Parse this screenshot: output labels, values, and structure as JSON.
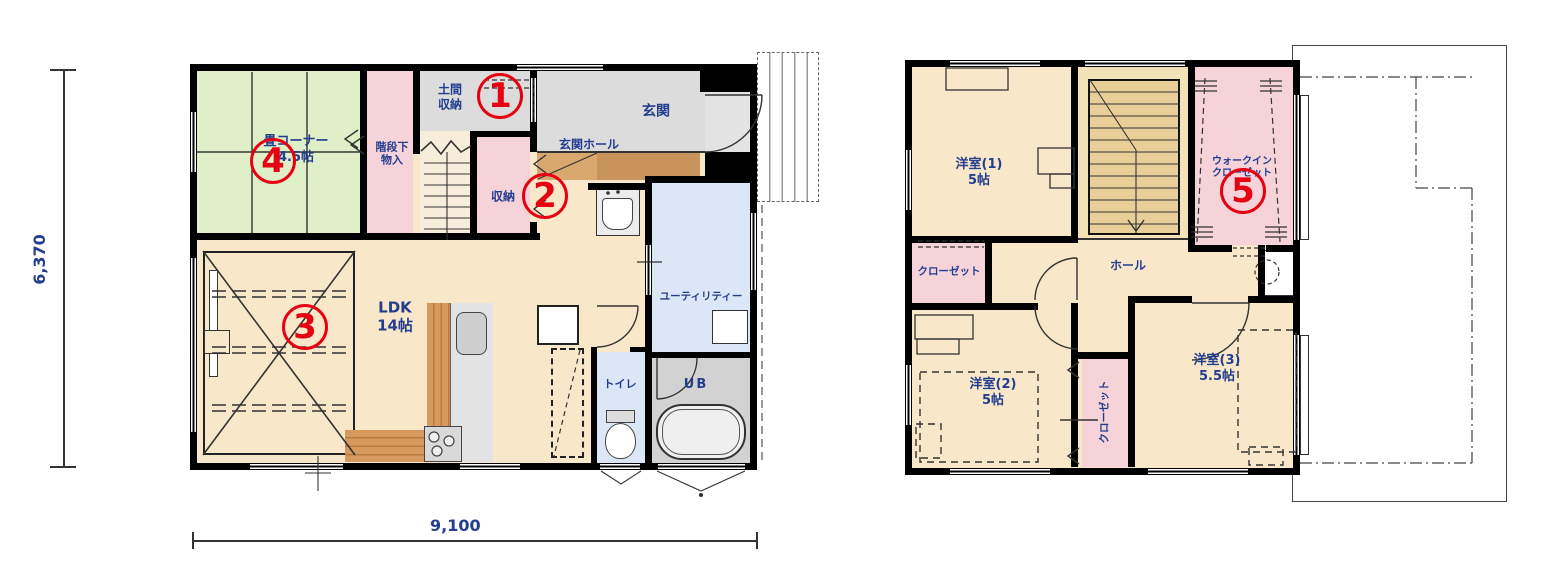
{
  "title": "2-story house floor plan",
  "dimensions": {
    "height_label": "6,370",
    "width_label": "9,100"
  },
  "floor1": {
    "rooms": {
      "tatami": {
        "label": "畳コーナー\n4.5帖"
      },
      "understair": {
        "label": "階段下\n物入"
      },
      "doma": {
        "label": "土間\n収納"
      },
      "storage": {
        "label": "収納"
      },
      "genkan": {
        "label": "玄関"
      },
      "genkan_hall": {
        "label": "玄関ホール"
      },
      "ldk": {
        "label": "LDK\n14帖"
      },
      "utility": {
        "label": "ユーティリティー"
      },
      "toilet": {
        "label": "トイレ"
      },
      "bath": {
        "label": "UB"
      }
    }
  },
  "floor2": {
    "rooms": {
      "room1": {
        "label": "洋室(1)\n5帖"
      },
      "closet1": {
        "label": "クローゼット"
      },
      "hall": {
        "label": "ホール"
      },
      "wic": {
        "label": "ウォークイン\nクローゼット"
      },
      "room2": {
        "label": "洋室(2)\n5帖"
      },
      "closet2": {
        "label": "クローゼット"
      },
      "room3": {
        "label": "洋室(3)\n5.5帖"
      }
    }
  },
  "markers": [
    "1",
    "2",
    "3",
    "4",
    "5"
  ],
  "colors": {
    "wall": "#000000",
    "floor_cream": "#f9e7c9",
    "tatami_green": "#dff0c8",
    "storage_pink": "#f6d3d8",
    "entry_gray": "#dcdcdc",
    "water_blue": "#dbe7f6",
    "bath_gray": "#d2d2d2",
    "stair_tan": "#e9cf97",
    "wood_brown": "#d79a5e",
    "marker_red": "#e60012",
    "label_navy": "#233d8f"
  }
}
